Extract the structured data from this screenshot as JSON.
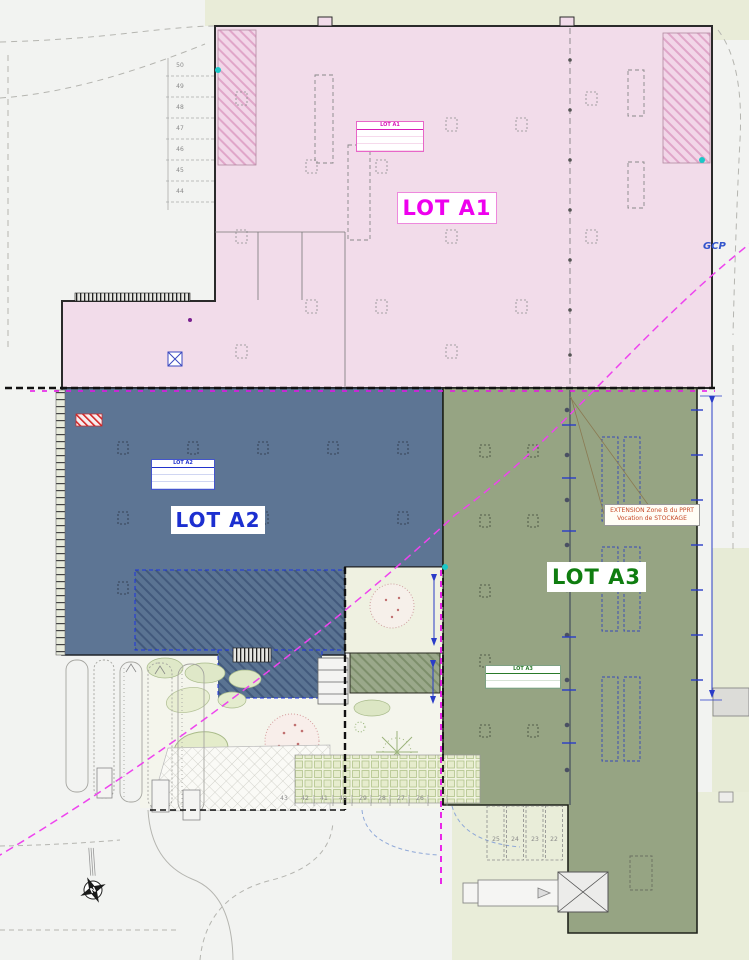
{
  "plan": {
    "lots": {
      "a1": {
        "label": "LOT A1",
        "color": "#ee00ee",
        "fill": "#f2dcea"
      },
      "a2": {
        "label": "LOT A2",
        "color": "#1c2fd0",
        "fill": "#5d7594"
      },
      "a3": {
        "label": "LOT A3",
        "color": "#0f7d10",
        "fill": "#96a483"
      }
    },
    "mini_tables": {
      "a1": "LOT A1",
      "a2": "LOT A2",
      "a3": "LOT A3"
    },
    "annotations": {
      "gcp": "GCP",
      "extension_line1": "EXTENSION Zone B du PPRT",
      "extension_line2": "Vocation de STOCKAGE",
      "north": "N"
    },
    "parking": {
      "left": [
        "50",
        "49",
        "48",
        "47",
        "46",
        "45",
        "44"
      ],
      "bottom": [
        "43",
        "42",
        "41",
        "40",
        "29",
        "28",
        "27",
        "26"
      ],
      "bottom_right": [
        "25",
        "24",
        "23",
        "22"
      ]
    },
    "colors": {
      "magenta_line": "#e811e8",
      "boundary": "#111111",
      "dimension_blue": "#2a3cc8",
      "cyan_marker": "#19c8c8"
    }
  }
}
